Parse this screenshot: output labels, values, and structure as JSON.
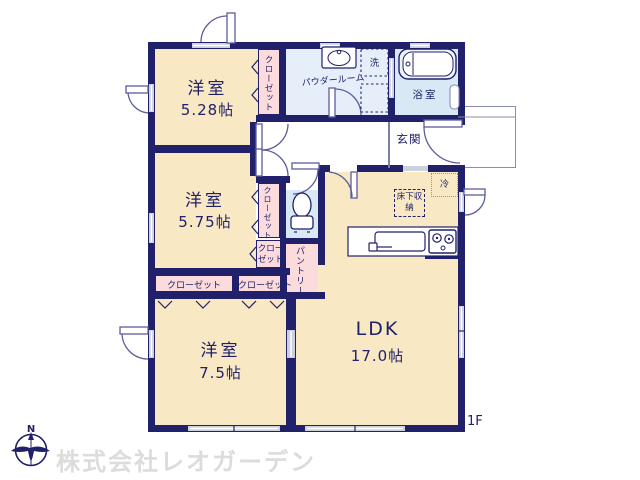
{
  "plan": {
    "floor_label": "1F",
    "room1": {
      "label": "洋室",
      "size": "5.28帖"
    },
    "room2": {
      "label": "洋室",
      "size": "5.75帖"
    },
    "room3": {
      "label": "洋室",
      "size": "7.5帖"
    },
    "ldk": {
      "label": "LDK",
      "size": "17.0帖"
    },
    "entrance_label": "玄関",
    "powder_room_label": "パウダールーム",
    "bathroom_label": "浴室",
    "washer_label": "洗",
    "fridge_label": "冷",
    "underfloor_storage_label": "床下収納",
    "pantry_label": "パントリー",
    "closets": {
      "room1_closet": "クローゼット",
      "room2_closet": "クローゼット",
      "hall_closet": "クローゼット",
      "closet_left": "クローゼット",
      "closet_right": "クローゼット"
    }
  },
  "footer": {
    "company_watermark": "株式会社レオガーデン",
    "compass_north": "N"
  },
  "colors": {
    "wall": "#21216b",
    "room_fill": "#f8e8c3",
    "closet_fill": "#fbdbdc",
    "wet_area_fill": "#d9e8f5",
    "text": "#21216b",
    "watermark": "#dcdcdc"
  }
}
